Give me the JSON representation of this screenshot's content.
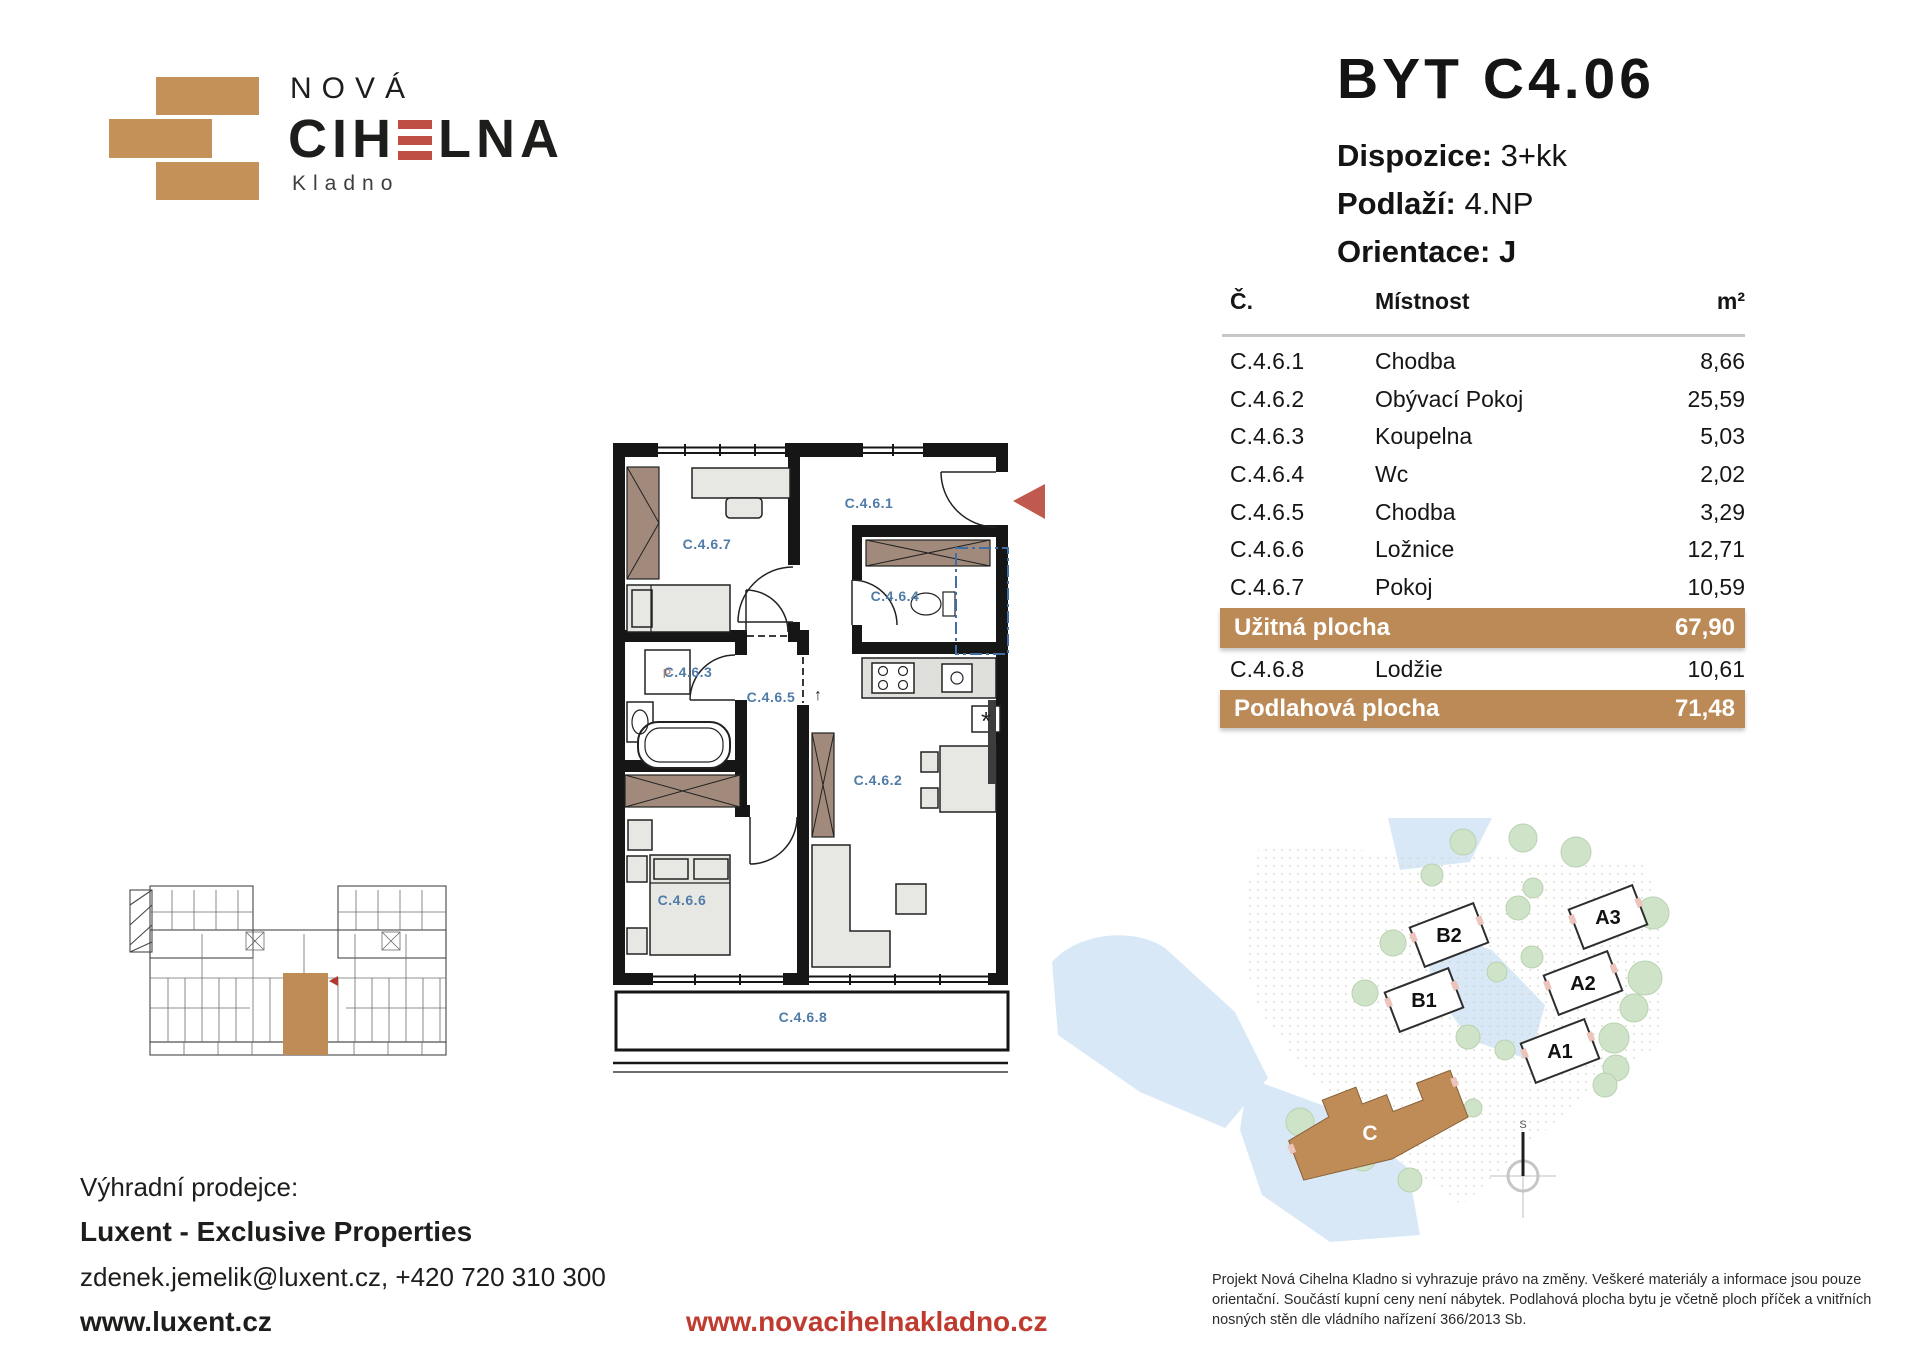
{
  "brand": {
    "name_top": "NOVÁ",
    "name_pre": "CIH",
    "name_post": "LNA",
    "city": "Kladno"
  },
  "title": {
    "unit": "BYT C4.06",
    "rows": [
      {
        "label": "Dispozice:",
        "value": "3+kk"
      },
      {
        "label": "Podlaží:",
        "value": "4.NP"
      },
      {
        "label": "Orientace:",
        "value": "J"
      }
    ]
  },
  "table": {
    "col_num": "Č.",
    "col_room": "Místnost",
    "col_area": "m²",
    "rows": [
      {
        "num": "C.4.6.1",
        "room": "Chodba",
        "area": "8,66"
      },
      {
        "num": "C.4.6.2",
        "room": "Obývací Pokoj",
        "area": "25,59"
      },
      {
        "num": "C.4.6.3",
        "room": "Koupelna",
        "area": "5,03"
      },
      {
        "num": "C.4.6.4",
        "room": "Wc",
        "area": "2,02"
      },
      {
        "num": "C.4.6.5",
        "room": "Chodba",
        "area": "3,29"
      },
      {
        "num": "C.4.6.6",
        "room": "Ložnice",
        "area": "12,71"
      },
      {
        "num": "C.4.6.7",
        "room": "Pokoj",
        "area": "10,59"
      }
    ],
    "useful": {
      "label": "Užitná plocha",
      "value": "67,90"
    },
    "loggia": {
      "num": "C.4.6.8",
      "room": "Lodžie",
      "area": "10,61"
    },
    "floor": {
      "label": "Podlahová plocha",
      "value": "71,48"
    }
  },
  "plan": {
    "labels": {
      "r1": "C.4.6.1",
      "r2": "C.4.6.2",
      "r3": "C.4.6.3",
      "r4": "C.4.6.4",
      "r5": "C.4.6.5",
      "r6": "C.4.6.6",
      "r7": "C.4.6.7",
      "r8": "C.4.6.8"
    },
    "washer": "P",
    "vent": "*",
    "direction": "↑"
  },
  "siteplan": {
    "buildings": {
      "b2": "B2",
      "b1": "B1",
      "a3": "A3",
      "a2": "A2",
      "a1": "A1",
      "c": "C"
    },
    "compass": "S"
  },
  "footer": {
    "seller_label": "Výhradní prodejce:",
    "seller_name": "Luxent - Exclusive Properties",
    "contact": "zdenek.jemelik@luxent.cz, +420 720 310 300",
    "seller_web": "www.luxent.cz",
    "project_web": "www.novacihelnakladno.cz",
    "disclaimer": "Projekt Nová Cihelna Kladno si vyhrazuje právo na změny. Veškeré materiály a informace jsou pouze orientační. Součástí kupní ceny není nábytek. Podlahová plocha bytu je včetně ploch příček a vnitřních nosných stěn dle vládního nařízení 366/2013 Sb."
  },
  "colors": {
    "brand_tan": "#c49158",
    "accent_tan": "#bc8a56",
    "accent_red": "#bf4f44",
    "link_red": "#bf3b2f",
    "label_blue": "#4f7ca7"
  }
}
